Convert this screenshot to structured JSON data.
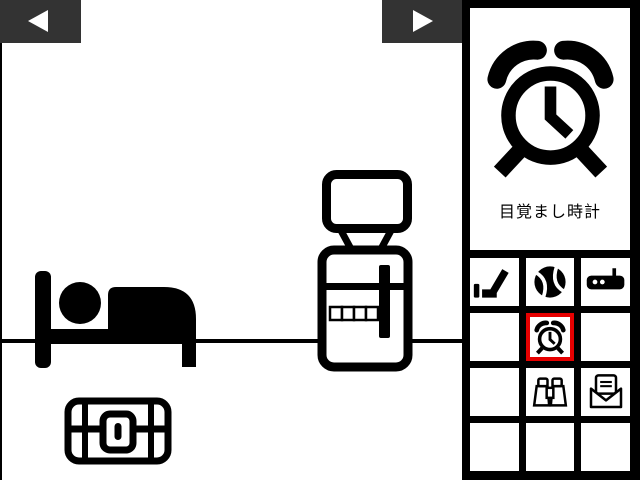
{
  "nav": {
    "back_button_icon": "left-arrow",
    "forward_button_icon": "right-arrow"
  },
  "scene": {
    "objects": [
      {
        "name": "bed"
      },
      {
        "name": "water-server",
        "code_panel_squares": 4
      },
      {
        "name": "treasure-chest",
        "locked": true
      }
    ]
  },
  "inventory": {
    "selected_item": {
      "name": "alarm-clock",
      "label": "目覚まし時計"
    },
    "grid": {
      "rows": 4,
      "cols": 3,
      "items": [
        {
          "row": 1,
          "col": 1,
          "icon": "golf-club"
        },
        {
          "row": 1,
          "col": 2,
          "icon": "ball"
        },
        {
          "row": 1,
          "col": 3,
          "icon": "radio"
        },
        {
          "row": 2,
          "col": 2,
          "icon": "alarm-clock",
          "selected": true
        },
        {
          "row": 3,
          "col": 2,
          "icon": "binoculars"
        },
        {
          "row": 3,
          "col": 3,
          "icon": "envelope"
        }
      ]
    }
  },
  "colors": {
    "background": "#ffffff",
    "nav_bar": "#333333",
    "frame": "#000000",
    "selection_border": "#e60000"
  }
}
